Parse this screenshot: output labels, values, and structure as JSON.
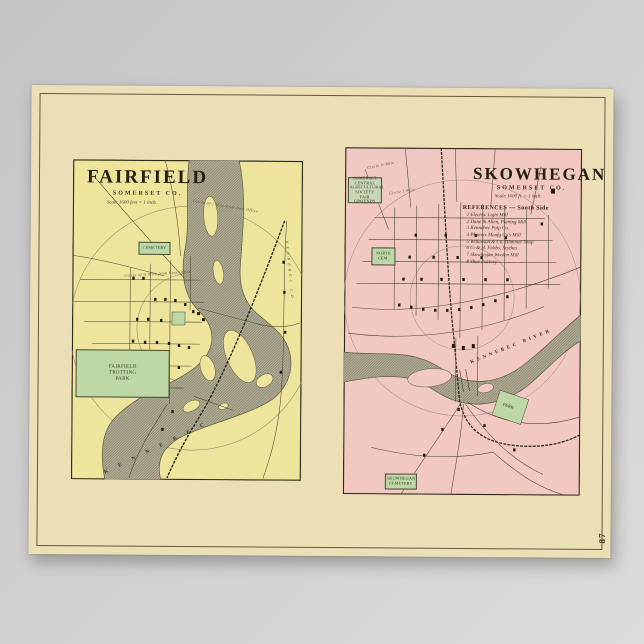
{
  "page": {
    "number": "87"
  },
  "fairfield": {
    "title": "FAIRFIELD",
    "county": "SOMERSET CO.",
    "scale": "Scale 1600 feet = 1 inch.",
    "labels": {
      "cemetery": "CEMETERY",
      "trotting_park": "FAIRFIELD TROTTING PARK",
      "river_name": "K E N N E B E C",
      "county_line": "KENNEBEC CO.",
      "circle_half": "Circle of ½ Mile from Post Office",
      "circle_one": "Circle of 1 Mile from Post Office"
    }
  },
  "skowhegan": {
    "title": "SKOWHEGAN",
    "county": "SOMERSET CO.",
    "scale": "Scale 1600 ft. = 1 inch.",
    "references_title": "REFERENCES — South Side",
    "references": [
      "1  Electric Light Mill",
      "2  Dane & Allen, Planing Mill",
      "3  Kennebec Pulp Co.",
      "4  Phoenix Manfg Co's Mill",
      "5  Wilkinson & Co. Hammer Shop",
      "6  C. & H. Fobbs, Scythes",
      "7  Skowhegan Woolen Mill",
      "8  Shoe Factory"
    ],
    "labels": {
      "fair_grounds": "SOMERSET CENTRAL AGRICULTURAL SOCIETY FAIR GROUNDS",
      "north_cem": "NORTH CEM.",
      "cemetery": "SKOWHEGAN CEMETERY",
      "park": "PARK",
      "river_east": "KENNEBEC  RIVER",
      "circle_half": "Circle ½ Mile",
      "circle_one": "Circle 1 Mile"
    }
  }
}
